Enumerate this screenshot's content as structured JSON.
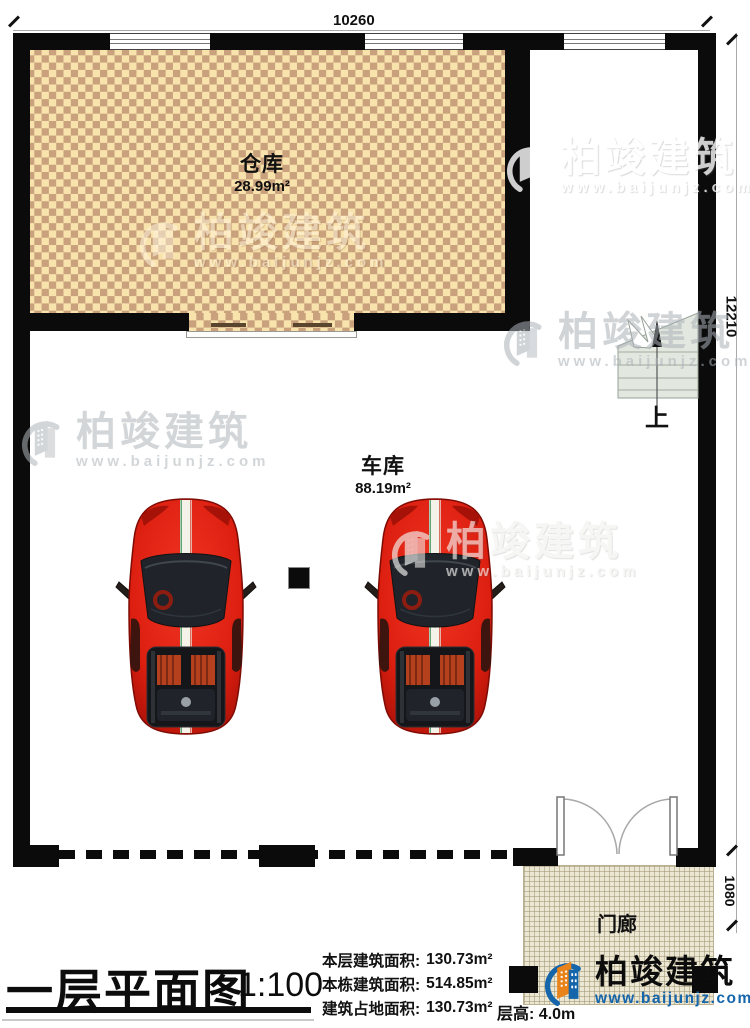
{
  "plan": {
    "dimensions": {
      "top": "10260",
      "right": "12210",
      "porch": "1080"
    },
    "rooms": {
      "storage": {
        "name": "仓库",
        "area": "28.99m²"
      },
      "garage": {
        "name": "车库",
        "area": "88.19m²"
      },
      "porch": {
        "name": "门廊"
      }
    },
    "stairs_up_label": "上"
  },
  "title_block": {
    "title": "一层平面图",
    "scale": "1:100",
    "stats": [
      {
        "label": "本层建筑面积:",
        "value": "130.73m²"
      },
      {
        "label": "本栋建筑面积:",
        "value": "514.85m²"
      },
      {
        "label": "建筑占地面积:",
        "value": "130.73m²"
      }
    ],
    "floor_height_label": "层高:",
    "floor_height_value": "4.0m"
  },
  "brand": {
    "name": "柏竣建筑",
    "url": "www.baijunjz.com"
  },
  "colors": {
    "wall": "#0b0b0b",
    "checker_light": "#f9e3ac",
    "checker_dark": "#c9a27d",
    "porch_floor": "#ece7d3",
    "stair_fill": "#e2e8df",
    "brand_blue": "#1565ab",
    "brand_orange": "#e8831c",
    "car_red": "#dc1f10"
  }
}
